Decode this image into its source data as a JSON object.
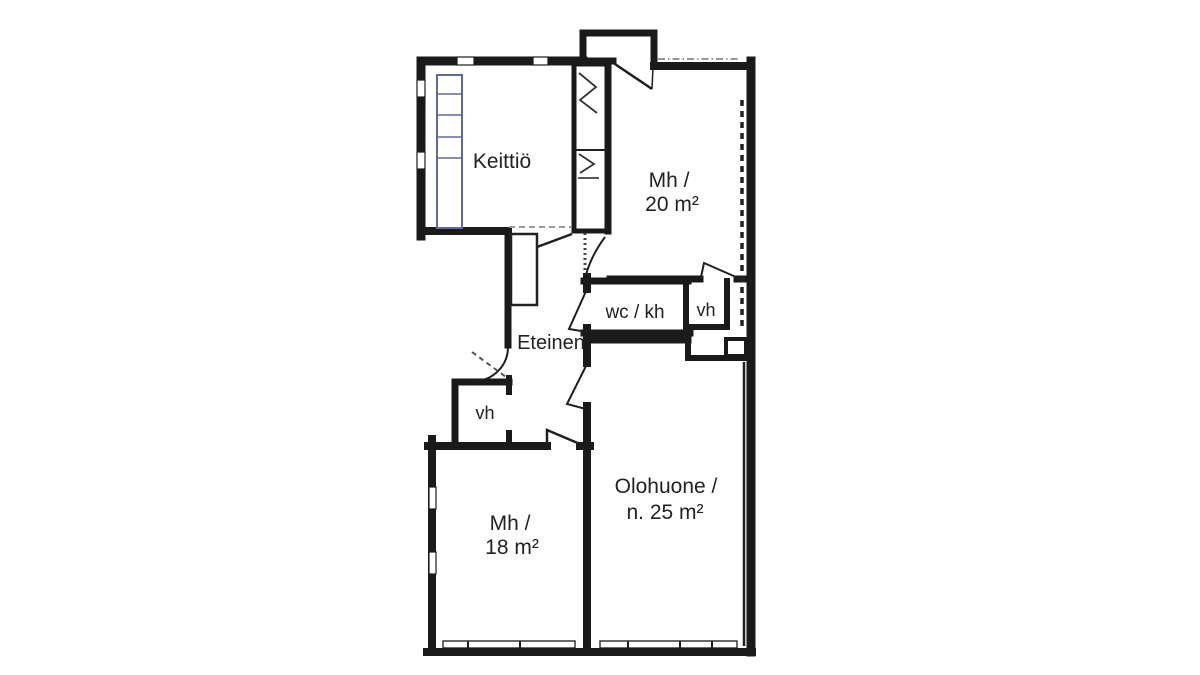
{
  "title": "Apartment floor plan",
  "colors": {
    "background": "#ffffff",
    "walls": "#1a1a1a",
    "cabinet_lines": "#5c6a9a",
    "dashed_guides": "#8a8a8a",
    "text": "#222222"
  },
  "rooms": {
    "kitchen": {
      "label": "Keittiö"
    },
    "bedroom20": {
      "line1": "Mh /",
      "line2": "20 m²"
    },
    "wc": {
      "label": "wc / kh"
    },
    "closetRight": {
      "label": "vh"
    },
    "hall": {
      "label": "Eteinen"
    },
    "closetLeft": {
      "label": "vh"
    },
    "bedroom18": {
      "line1": "Mh /",
      "line2": "18 m²"
    },
    "living": {
      "line1": "Olohuone /",
      "line2": "n. 25 m²"
    }
  }
}
